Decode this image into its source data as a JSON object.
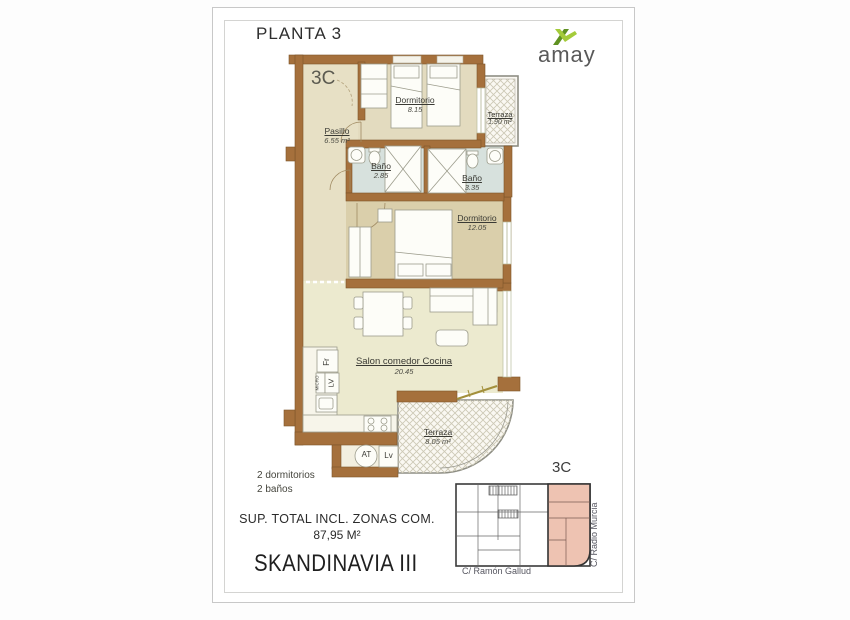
{
  "page": {
    "floor_title": "PLANTA 3",
    "unit_label": "3C",
    "project_name": "SKANDINAVIA III",
    "total_area_label": "SUP. TOTAL INCL. ZONAS COM.",
    "total_area_value": "87,95 M²"
  },
  "features": {
    "line1": "2 dormitorios",
    "line2": "2 baños"
  },
  "logo": {
    "text": "amay",
    "icon": "amay-x-icon",
    "dark_green": "#5f9121",
    "light_green": "#a4cb3a"
  },
  "rooms": {
    "dormitorio1": {
      "name": "Dormitorio",
      "area": "8.15"
    },
    "terraza1": {
      "name": "Terraza",
      "area": "1.90 m²"
    },
    "pasillo": {
      "name": "Pasillo",
      "area": "6.55 m²"
    },
    "bano1": {
      "name": "Baño",
      "area": "2.85"
    },
    "bano2": {
      "name": "Baño",
      "area": "3.35"
    },
    "dormitorio2": {
      "name": "Dormitorio",
      "area": "12.05"
    },
    "salon": {
      "name": "Salon comedor Cocina",
      "area": "20.45"
    },
    "terraza2": {
      "name": "Terraza",
      "area": "8.05 m²"
    }
  },
  "appliances": {
    "fridge": "Fr",
    "dishwasher": "LV",
    "microwave": "MICRO",
    "water_heater": "AT",
    "laundry": "Lv"
  },
  "keyplan": {
    "unit_label": "3C",
    "street_bottom": "C/ Ramón Gallud",
    "street_right": "C/ Radio Murcia",
    "highlight_color": "#eec3b2"
  },
  "colors": {
    "wall_brown": "#a5703c",
    "room_beige": "#e3dbbf",
    "room_tan": "#dacfab",
    "bathroom_blue": "#d7e1dd",
    "salon_cream": "#eceacf"
  }
}
